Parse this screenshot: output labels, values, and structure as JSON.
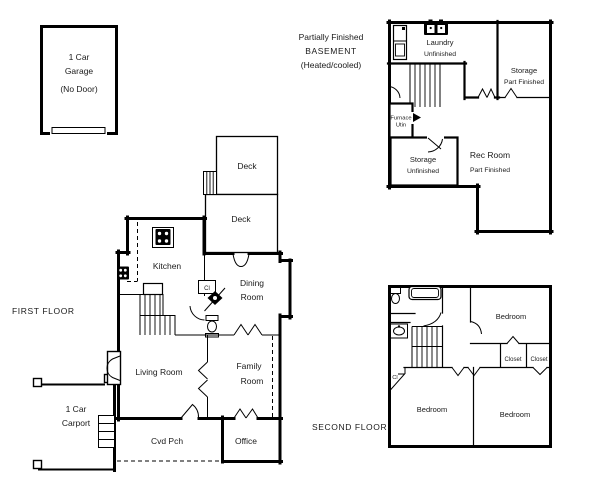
{
  "colors": {
    "ink": "#000000",
    "paper": "#ffffff"
  },
  "garage": {
    "line1": "1 Car",
    "line2": "Garage",
    "line3": "(No Door)"
  },
  "first_floor": {
    "title": "FIRST FLOOR",
    "deck_upper": "Deck",
    "deck_lower": "Deck",
    "kitchen": "Kitchen",
    "dining_line1": "Dining",
    "dining_line2": "Room",
    "closet_abbrev": "Cl",
    "living_room": "Living Room",
    "family_line1": "Family",
    "family_line2": "Room",
    "carport_line1": "1 Car",
    "carport_line2": "Carport",
    "covered_porch": "Cvd Pch",
    "office": "Office"
  },
  "basement": {
    "header_line1": "Partially Finished",
    "header_line2": "BASEMENT",
    "header_line3": "(Heated/cooled)",
    "laundry_line1": "Laundry",
    "laundry_line2": "Unfinished",
    "storage_right_line1": "Storage",
    "storage_right_line2": "Part Finished",
    "furnace_line1": "Furnace",
    "furnace_line2": "Utin",
    "storage_left_line1": "Storage",
    "storage_left_line2": "Unfinished",
    "rec_line1": "Rec Room",
    "rec_line2": "Part Finished"
  },
  "second_floor": {
    "title": "SECOND FLOOR",
    "bedroom_top": "Bedroom",
    "closet_left": "Closet",
    "closet_right": "Closet",
    "closet_abbrev": "Cl",
    "bedroom_bottom_left": "Bedroom",
    "bedroom_bottom_right": "Bedroom"
  }
}
